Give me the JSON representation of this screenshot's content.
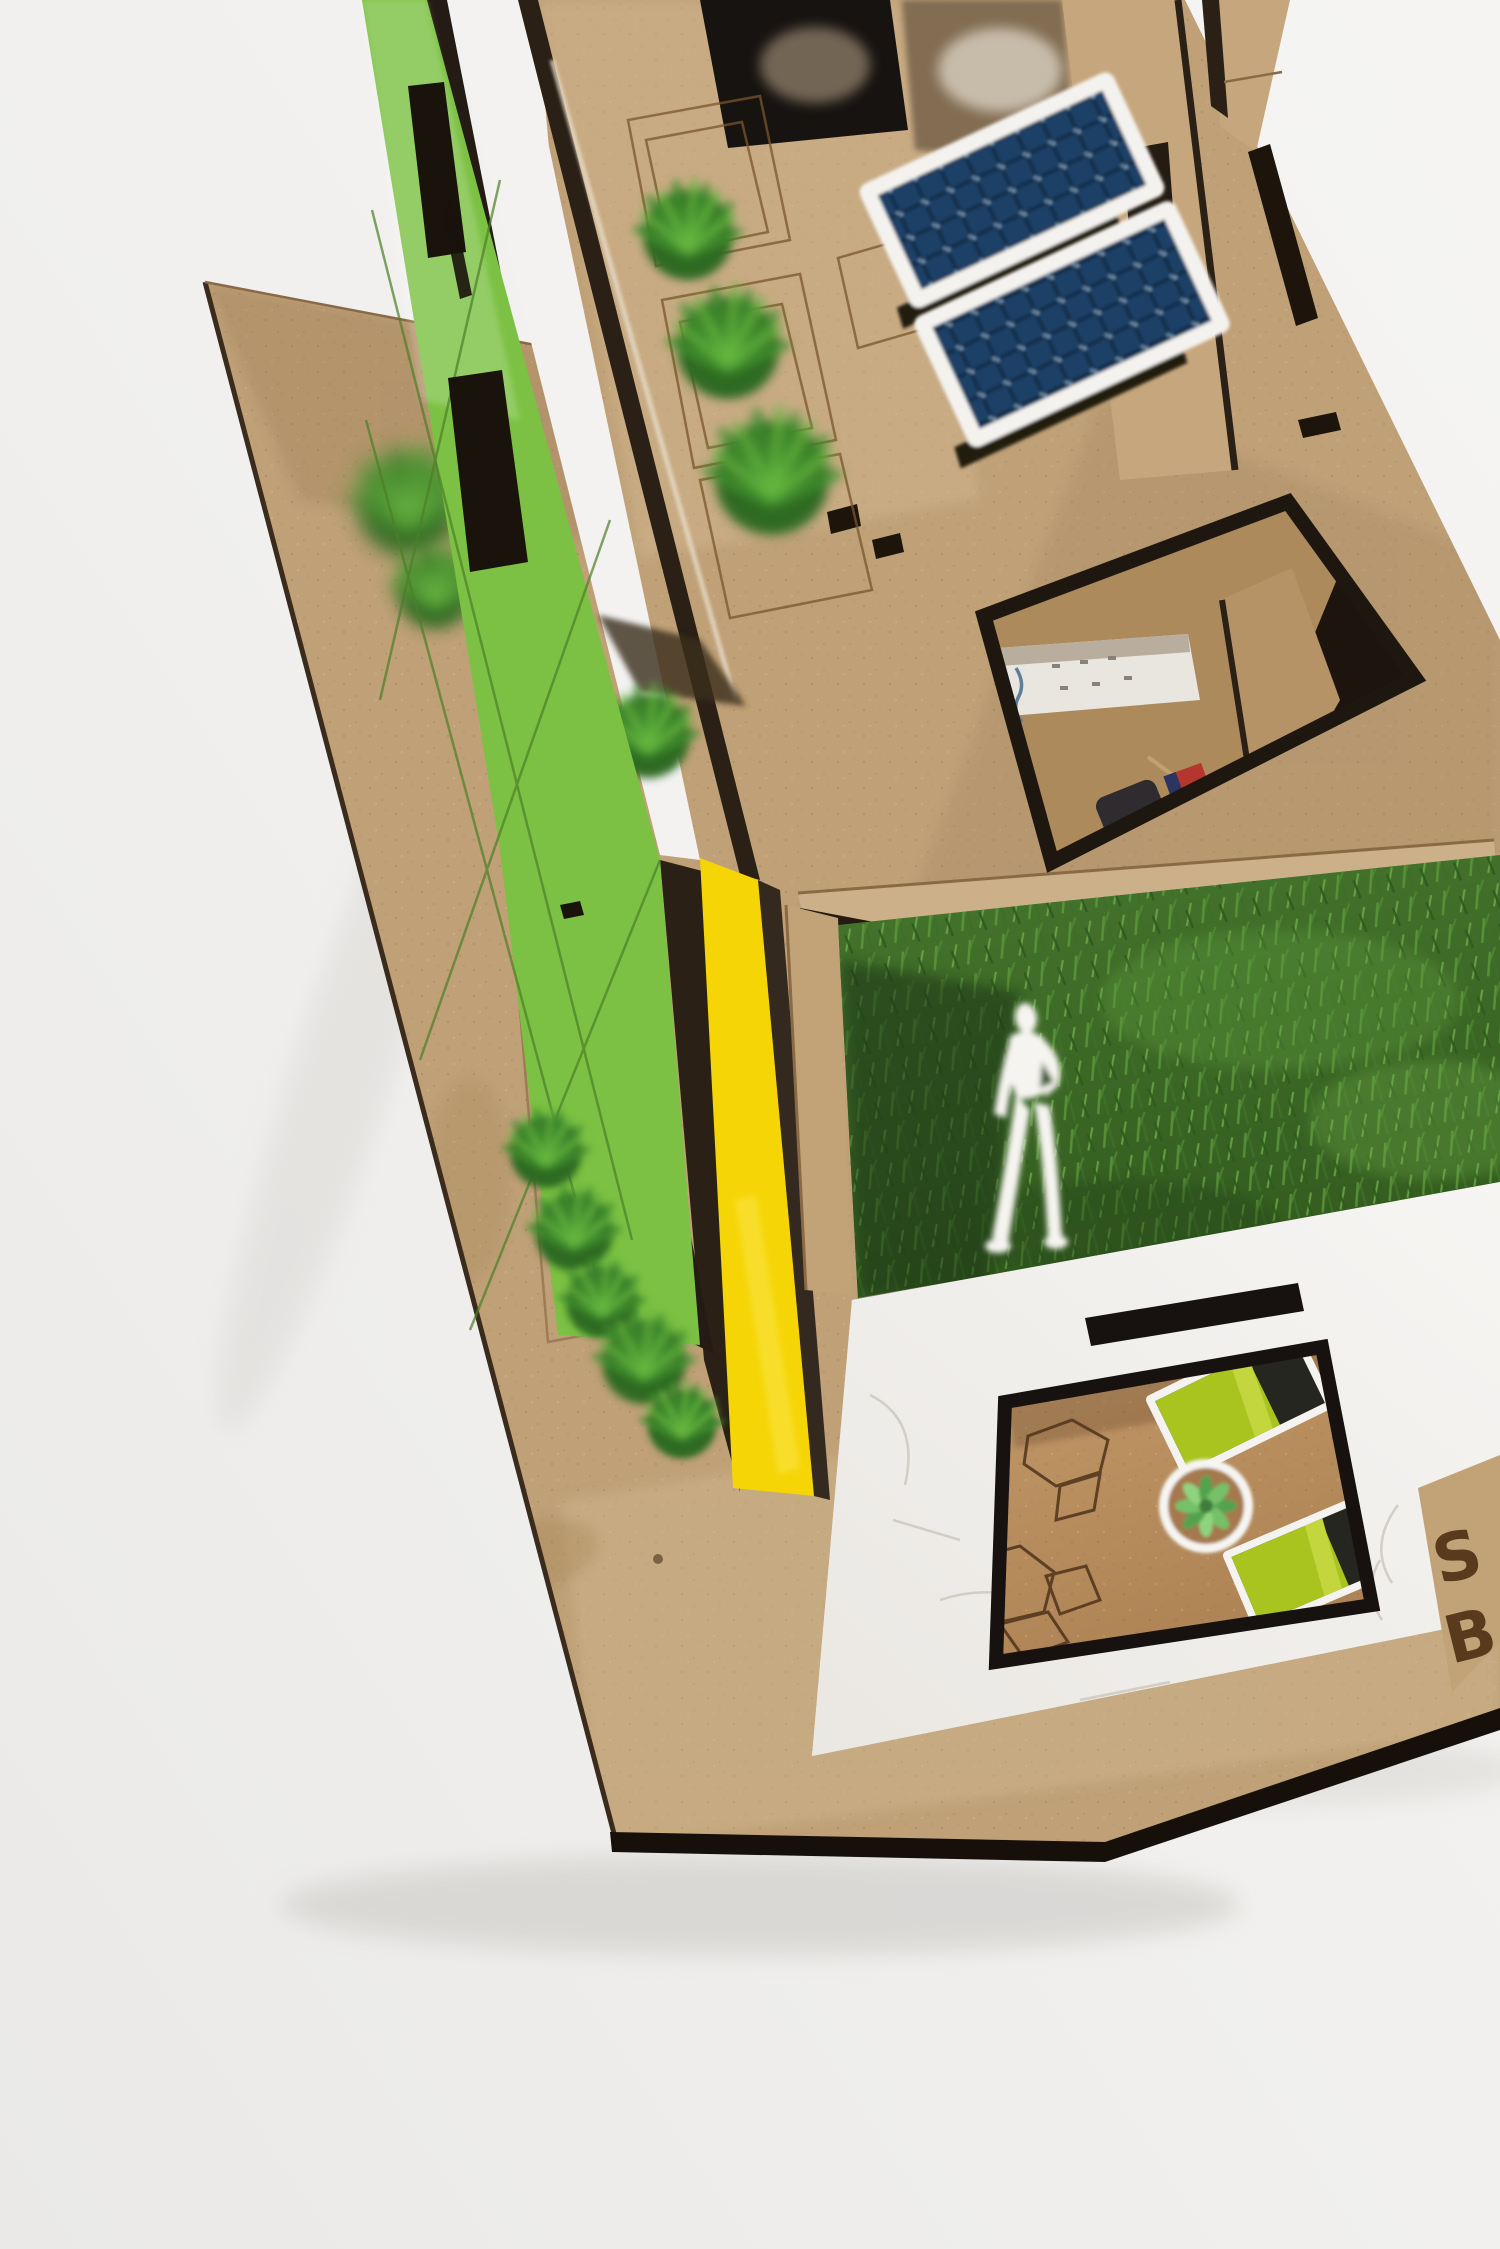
{
  "scene": {
    "title": "Sustainable house concept - laser-cut cardboard architectural model",
    "setting": "close-up photo of a scale model on a white studio backdrop",
    "engraved_sign": {
      "line1": "S",
      "line2": "B"
    },
    "colors": {
      "background": "#f1f0ee",
      "cardboard": "#bfa077",
      "cardboard_dark_edge": "#261d14",
      "green_facade": "#7cc143",
      "yellow_wall": "#f5d506",
      "roof_grass": "#3e6b29",
      "shrub_green": "#55a637",
      "solar_cell_blue": "#1d4166",
      "solar_frame_white": "#f4f2ee",
      "white_plaster": "#f3f1ee",
      "courtyard_floor": "#bb8f60",
      "sofa_green": "#a9c41e",
      "accent_red": "#b5362e",
      "figure_white": "#f6f4f0"
    },
    "objects": [
      "kraft base board",
      "green engraved lattice facade wall",
      "yellow side wall panel",
      "roof deck with two solar panels",
      "planter boxes with shrubs",
      "floor opening revealing bedroom with bed, rug and red cushion",
      "second-floor grass terrace",
      "white human scale figure",
      "white plaster ground-floor facade",
      "courtyard with two green sofas and potted plant",
      "engraved initials on base edge"
    ]
  }
}
